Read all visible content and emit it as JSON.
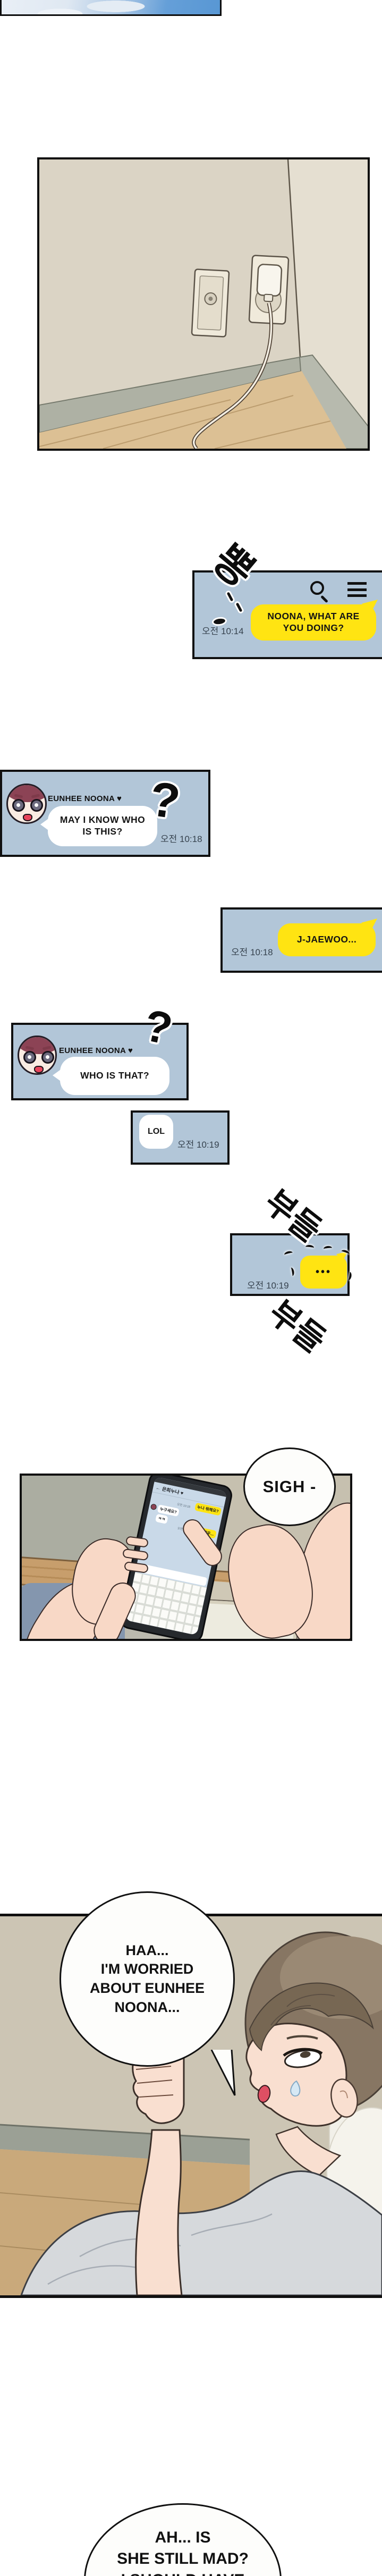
{
  "colors": {
    "chat_bg": "#b2c6d8",
    "bubble_yellow": "#ffe412",
    "balloon_white": "#fdfdfb",
    "panel_border": "#101010",
    "timestamp": "#36424e"
  },
  "sfx": {
    "pop": "뽕",
    "tremble_top": "부들",
    "tremble_bottom": "부들"
  },
  "chat_app": {
    "panel1": {
      "time": "오전 10:14",
      "message_l1": "NOONA, WHAT ARE",
      "message_l2": "YOU DOING?"
    },
    "panel2": {
      "sender": "EUNHEE NOONA ♥",
      "qmark": "?",
      "message_l1": "MAY I KNOW WHO",
      "message_l2": "IS THIS?",
      "time": "오전 10:18"
    },
    "panel3": {
      "message": "J-JAEWOO...",
      "time": "오전 10:18"
    },
    "panel4": {
      "sender": "EUNHEE NOONA ♥",
      "qmark": "?",
      "message": "WHO IS THAT?"
    },
    "panel5": {
      "message": "LOL",
      "time": "오전 10:19"
    },
    "panel6": {
      "typing_dots": "•••",
      "time": "오전 10:19"
    }
  },
  "phone_scene": {
    "sigh": "SIGH -",
    "screen": {
      "back_arrow": "←",
      "title": "은희누나 ♥",
      "right_bubble_1": "누나 뭐해요?",
      "time_1": "오전 10:18",
      "left_bubble_1": "누구세요?",
      "left_bubble_2": "ㅋㅋ",
      "right_bubble_2": "저 재우...",
      "time_2": "오전 10:19"
    }
  },
  "bed_scene": {
    "speech_l1": "HAA...",
    "speech_l2": "I'M WORRIED",
    "speech_l3": "ABOUT EUNHEE",
    "speech_l4": "NOONA..."
  },
  "outro_balloon": {
    "l1": "AH... IS",
    "l2": "SHE STILL MAD?",
    "l3": "I SHOULD HAVE"
  }
}
